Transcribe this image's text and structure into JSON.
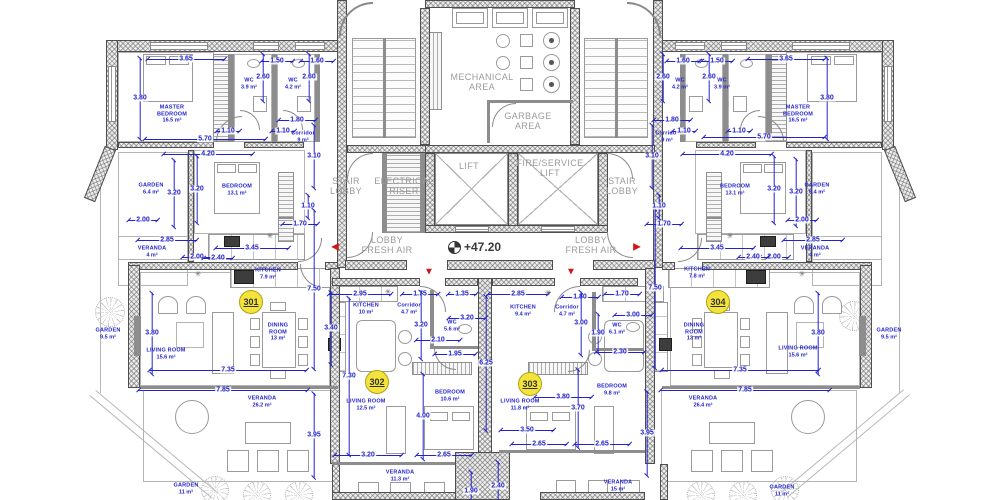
{
  "drawing": {
    "type": "floor-plan",
    "level_marker": "+47.20"
  },
  "colors": {
    "dimension_blue": "#2323cd",
    "label_gray": "#9b9b9b",
    "badge_yellow": "#f4e33b",
    "arrow_red": "#cf1717",
    "wall_gray": "#4e4e4e"
  },
  "icons": {
    "sink": "✳"
  },
  "arrow_glyphs": {
    "left": "◀",
    "right": "▶",
    "down": "▼"
  },
  "units": [
    {
      "number": "301",
      "x": 251,
      "y": 302
    },
    {
      "number": "302",
      "x": 377,
      "y": 382
    },
    {
      "number": "303",
      "x": 530,
      "y": 384
    },
    {
      "number": "304",
      "x": 718,
      "y": 302
    }
  ],
  "core_labels": [
    {
      "text": "MECHANICAL\nAREA",
      "x": 482,
      "y": 82
    },
    {
      "text": "GARBAGE\nAREA",
      "x": 528,
      "y": 121
    },
    {
      "text": "STAIR\nLOBBY",
      "x": 346,
      "y": 186
    },
    {
      "text": "ELECTRICAL\nRISER",
      "x": 404,
      "y": 186
    },
    {
      "text": "LIFT",
      "x": 469,
      "y": 166
    },
    {
      "text": "FIRE/SERVICE\nLIFT",
      "x": 550,
      "y": 168
    },
    {
      "text": "STAIR\nLOBBY",
      "x": 622,
      "y": 186
    },
    {
      "text": "LOBBY\nFRESH AIR",
      "x": 387,
      "y": 245
    },
    {
      "text": "LOBBY\nFRESH AIR",
      "x": 591,
      "y": 245
    }
  ],
  "rooms": [
    {
      "name": "MASTER\nBEDROOM",
      "area": "16.5 m²",
      "x": 172,
      "y": 114
    },
    {
      "name": "WC",
      "area": "3.9 m²",
      "x": 249,
      "y": 84
    },
    {
      "name": "WC",
      "area": "4.2 m²",
      "x": 293,
      "y": 84
    },
    {
      "name": "Corridor",
      "area": "9 m²",
      "x": 303,
      "y": 137
    },
    {
      "name": "BEDROOM",
      "area": "13.1 m²",
      "x": 237,
      "y": 190
    },
    {
      "name": "GARDEN",
      "area": "6.4 m²",
      "x": 151,
      "y": 189
    },
    {
      "name": "VERANDA",
      "area": "4 m²",
      "x": 152,
      "y": 252
    },
    {
      "name": "KITCHEN",
      "area": "7.9 m²",
      "x": 268,
      "y": 274
    },
    {
      "name": "DINING\nROOM",
      "area": "13 m²",
      "x": 278,
      "y": 332
    },
    {
      "name": "LIVING ROOM",
      "area": "15.6 m²",
      "x": 166,
      "y": 354
    },
    {
      "name": "GARDEN",
      "area": "9.5 m²",
      "x": 108,
      "y": 334
    },
    {
      "name": "VERANDA",
      "area": "26.2 m²",
      "x": 262,
      "y": 402
    },
    {
      "name": "GARDEN",
      "area": "11 m²",
      "x": 186,
      "y": 489
    },
    {
      "name": "KITCHEN",
      "area": "10 m²",
      "x": 366,
      "y": 309
    },
    {
      "name": "Corridor",
      "area": "4.7 m²",
      "x": 409,
      "y": 309
    },
    {
      "name": "WC",
      "area": "5.6 m²",
      "x": 452,
      "y": 326
    },
    {
      "name": "BEDROOM",
      "area": "10.6 m²",
      "x": 450,
      "y": 396
    },
    {
      "name": "LIVING ROOM",
      "area": "12.5 m²",
      "x": 366,
      "y": 405
    },
    {
      "name": "VERANDA",
      "area": "11.3 m²",
      "x": 400,
      "y": 476
    },
    {
      "name": "KITCHEN",
      "area": "9.4 m²",
      "x": 523,
      "y": 311
    },
    {
      "name": "Corridor",
      "area": "4.7 m²",
      "x": 567,
      "y": 311
    },
    {
      "name": "WC",
      "area": "6.1 m²",
      "x": 617,
      "y": 329
    },
    {
      "name": "BEDROOM",
      "area": "9.8 m²",
      "x": 612,
      "y": 390
    },
    {
      "name": "LIVING ROOM",
      "area": "11.8 m²",
      "x": 520,
      "y": 405
    },
    {
      "name": "VERANDA",
      "area": "15 m²",
      "x": 618,
      "y": 486
    },
    {
      "name": "MASTER\nBEDROOM",
      "area": "16.5 m²",
      "x": 798,
      "y": 114
    },
    {
      "name": "WC",
      "area": "4.2 m²",
      "x": 680,
      "y": 84
    },
    {
      "name": "WC",
      "area": "3.9 m²",
      "x": 722,
      "y": 84
    },
    {
      "name": "Corridor",
      "area": "9 m²",
      "x": 667,
      "y": 137
    },
    {
      "name": "BEDROOM",
      "area": "13.1 m²",
      "x": 735,
      "y": 190
    },
    {
      "name": "GARDEN",
      "area": "6.4 m²",
      "x": 817,
      "y": 189
    },
    {
      "name": "VERANDA",
      "area": "4 m²",
      "x": 815,
      "y": 252
    },
    {
      "name": "KITCHEN",
      "area": "7.8 m²",
      "x": 697,
      "y": 273
    },
    {
      "name": "DINING\nROOM",
      "area": "13 m²",
      "x": 694,
      "y": 332
    },
    {
      "name": "LIVING ROOM",
      "area": "15.6 m²",
      "x": 798,
      "y": 352
    },
    {
      "name": "GARDEN",
      "area": "9.5 m²",
      "x": 889,
      "y": 334
    },
    {
      "name": "VERANDA",
      "area": "26.4 m²",
      "x": 703,
      "y": 402
    },
    {
      "name": "GARDEN",
      "area": "11 m²",
      "x": 782,
      "y": 491
    }
  ],
  "dims": [
    {
      "t": "3.65",
      "x": 186,
      "y": 59,
      "d": "h",
      "l": 78
    },
    {
      "t": "1.50",
      "x": 277,
      "y": 61,
      "d": "h",
      "l": 32
    },
    {
      "t": "1.60",
      "x": 317,
      "y": 61,
      "d": "h",
      "l": 34
    },
    {
      "t": "2.60",
      "x": 263,
      "y": 77,
      "d": "v",
      "l": 48
    },
    {
      "t": "2.60",
      "x": 309,
      "y": 77,
      "d": "v",
      "l": 48
    },
    {
      "t": "3.80",
      "x": 140,
      "y": 98,
      "d": "v",
      "l": 82
    },
    {
      "t": "5.70",
      "x": 205,
      "y": 139,
      "d": "h",
      "l": 122
    },
    {
      "t": "1.10",
      "x": 228,
      "y": 131,
      "d": "h",
      "l": 24
    },
    {
      "t": "1.10",
      "x": 283,
      "y": 131,
      "d": "h",
      "l": 24
    },
    {
      "t": "1.80",
      "x": 297,
      "y": 120,
      "d": "h",
      "l": 38
    },
    {
      "t": "3.10",
      "x": 314,
      "y": 156,
      "d": "v",
      "l": 64
    },
    {
      "t": "1.10",
      "x": 308,
      "y": 206,
      "d": "v",
      "l": 24
    },
    {
      "t": "1.70",
      "x": 300,
      "y": 224,
      "d": "h",
      "l": 36
    },
    {
      "t": "4.20",
      "x": 208,
      "y": 154,
      "d": "h",
      "l": 90
    },
    {
      "t": "3.20",
      "x": 174,
      "y": 193,
      "d": "v",
      "l": 68
    },
    {
      "t": "3.20",
      "x": 197,
      "y": 189,
      "d": "v",
      "l": 68
    },
    {
      "t": "2.00",
      "x": 143,
      "y": 220,
      "d": "h",
      "l": 30
    },
    {
      "t": "2.85",
      "x": 167,
      "y": 240,
      "d": "h",
      "l": 60
    },
    {
      "t": "2.00",
      "x": 197,
      "y": 257,
      "d": "h",
      "l": 30
    },
    {
      "t": "2.40",
      "x": 218,
      "y": 258,
      "d": "h",
      "l": 30
    },
    {
      "t": "3.45",
      "x": 252,
      "y": 248,
      "d": "h",
      "l": 74
    },
    {
      "t": "3.80",
      "x": 152,
      "y": 333,
      "d": "v",
      "l": 82
    },
    {
      "t": "7.50",
      "x": 314,
      "y": 289,
      "d": "v",
      "l": 160
    },
    {
      "t": "7.35",
      "x": 228,
      "y": 370,
      "d": "h",
      "l": 158
    },
    {
      "t": "7.85",
      "x": 223,
      "y": 390,
      "d": "h",
      "l": 170
    },
    {
      "t": "3.95",
      "x": 314,
      "y": 435,
      "d": "v",
      "l": 85
    },
    {
      "t": "2.95",
      "x": 360,
      "y": 294,
      "d": "h",
      "l": 63
    },
    {
      "t": "1.75",
      "x": 420,
      "y": 294,
      "d": "h",
      "l": 37
    },
    {
      "t": "1.35",
      "x": 462,
      "y": 294,
      "d": "h",
      "l": 29
    },
    {
      "t": "3.40",
      "x": 331,
      "y": 328,
      "d": "v",
      "l": 73
    },
    {
      "t": "3.20",
      "x": 421,
      "y": 325,
      "d": "v",
      "l": 68
    },
    {
      "t": "3.20",
      "x": 467,
      "y": 318,
      "d": "h",
      "l": 38
    },
    {
      "t": "2.10",
      "x": 438,
      "y": 340,
      "d": "h",
      "l": 45
    },
    {
      "t": "1.95",
      "x": 455,
      "y": 354,
      "d": "h",
      "l": 42
    },
    {
      "t": "7.30",
      "x": 349,
      "y": 376,
      "d": "v",
      "l": 158
    },
    {
      "t": "4.00",
      "x": 423,
      "y": 416,
      "d": "v",
      "l": 86
    },
    {
      "t": "6.25",
      "x": 486,
      "y": 363,
      "d": "v",
      "l": 135
    },
    {
      "t": "3.20",
      "x": 368,
      "y": 455,
      "d": "h",
      "l": 68
    },
    {
      "t": "2.65",
      "x": 444,
      "y": 455,
      "d": "h",
      "l": 56
    },
    {
      "t": "1.90",
      "x": 471,
      "y": 491,
      "d": "v",
      "l": 40
    },
    {
      "t": "2.85",
      "x": 518,
      "y": 294,
      "d": "h",
      "l": 61
    },
    {
      "t": "1.80",
      "x": 580,
      "y": 297,
      "d": "h",
      "l": 38
    },
    {
      "t": "1.70",
      "x": 622,
      "y": 294,
      "d": "h",
      "l": 36
    },
    {
      "t": "3.00",
      "x": 581,
      "y": 323,
      "d": "v",
      "l": 64
    },
    {
      "t": "3.00",
      "x": 633,
      "y": 315,
      "d": "h",
      "l": 38
    },
    {
      "t": "1.90",
      "x": 598,
      "y": 333,
      "d": "v",
      "l": 40
    },
    {
      "t": "2.30",
      "x": 620,
      "y": 352,
      "d": "h",
      "l": 49
    },
    {
      "t": "3.80",
      "x": 563,
      "y": 397,
      "d": "h",
      "l": 58
    },
    {
      "t": "3.70",
      "x": 578,
      "y": 408,
      "d": "v",
      "l": 79
    },
    {
      "t": "7.50",
      "x": 655,
      "y": 288,
      "d": "v",
      "l": 160
    },
    {
      "t": "3.50",
      "x": 527,
      "y": 430,
      "d": "h",
      "l": 54
    },
    {
      "t": "2.65",
      "x": 539,
      "y": 444,
      "d": "h",
      "l": 56
    },
    {
      "t": "2.65",
      "x": 602,
      "y": 444,
      "d": "h",
      "l": 56
    },
    {
      "t": "2.40",
      "x": 498,
      "y": 486,
      "d": "v",
      "l": 50
    },
    {
      "t": "3.95",
      "x": 647,
      "y": 433,
      "d": "v",
      "l": 85
    },
    {
      "t": "3.10",
      "x": 652,
      "y": 156,
      "d": "v",
      "l": 64
    },
    {
      "t": "1.10",
      "x": 659,
      "y": 206,
      "d": "v",
      "l": 24
    },
    {
      "t": "1.70",
      "x": 664,
      "y": 224,
      "d": "h",
      "l": 36
    },
    {
      "t": "1.60",
      "x": 683,
      "y": 61,
      "d": "h",
      "l": 34
    },
    {
      "t": "1.50",
      "x": 717,
      "y": 61,
      "d": "h",
      "l": 32
    },
    {
      "t": "3.65",
      "x": 786,
      "y": 59,
      "d": "h",
      "l": 78
    },
    {
      "t": "2.60",
      "x": 663,
      "y": 77,
      "d": "v",
      "l": 48
    },
    {
      "t": "2.60",
      "x": 709,
      "y": 77,
      "d": "v",
      "l": 48
    },
    {
      "t": "3.80",
      "x": 827,
      "y": 98,
      "d": "v",
      "l": 82
    },
    {
      "t": "1.80",
      "x": 672,
      "y": 120,
      "d": "h",
      "l": 38
    },
    {
      "t": "1.10",
      "x": 684,
      "y": 131,
      "d": "h",
      "l": 24
    },
    {
      "t": "1.10",
      "x": 739,
      "y": 131,
      "d": "h",
      "l": 24
    },
    {
      "t": "5.70",
      "x": 764,
      "y": 137,
      "d": "h",
      "l": 122
    },
    {
      "t": "4.20",
      "x": 727,
      "y": 154,
      "d": "h",
      "l": 90
    },
    {
      "t": "3.20",
      "x": 774,
      "y": 189,
      "d": "v",
      "l": 68
    },
    {
      "t": "3.20",
      "x": 796,
      "y": 192,
      "d": "v",
      "l": 68
    },
    {
      "t": "2.00",
      "x": 802,
      "y": 220,
      "d": "h",
      "l": 30
    },
    {
      "t": "2.85",
      "x": 813,
      "y": 240,
      "d": "h",
      "l": 60
    },
    {
      "t": "2.00",
      "x": 774,
      "y": 257,
      "d": "h",
      "l": 30
    },
    {
      "t": "2.40",
      "x": 753,
      "y": 257,
      "d": "h",
      "l": 30
    },
    {
      "t": "3.45",
      "x": 717,
      "y": 248,
      "d": "h",
      "l": 74
    },
    {
      "t": "3.80",
      "x": 818,
      "y": 333,
      "d": "v",
      "l": 82
    },
    {
      "t": "7.35",
      "x": 740,
      "y": 370,
      "d": "h",
      "l": 158
    },
    {
      "t": "7.85",
      "x": 745,
      "y": 390,
      "d": "h",
      "l": 170
    }
  ],
  "arrows": [
    {
      "dir": "left",
      "x": 335,
      "y": 247
    },
    {
      "dir": "right",
      "x": 637,
      "y": 247
    },
    {
      "dir": "down",
      "x": 429,
      "y": 272
    },
    {
      "dir": "down",
      "x": 571,
      "y": 272
    }
  ],
  "fixtures": [
    {
      "x": 198,
      "y": 274
    },
    {
      "x": 270,
      "y": 236
    },
    {
      "x": 388,
      "y": 292
    },
    {
      "x": 548,
      "y": 293
    },
    {
      "x": 730,
      "y": 236
    },
    {
      "x": 802,
      "y": 274
    }
  ]
}
